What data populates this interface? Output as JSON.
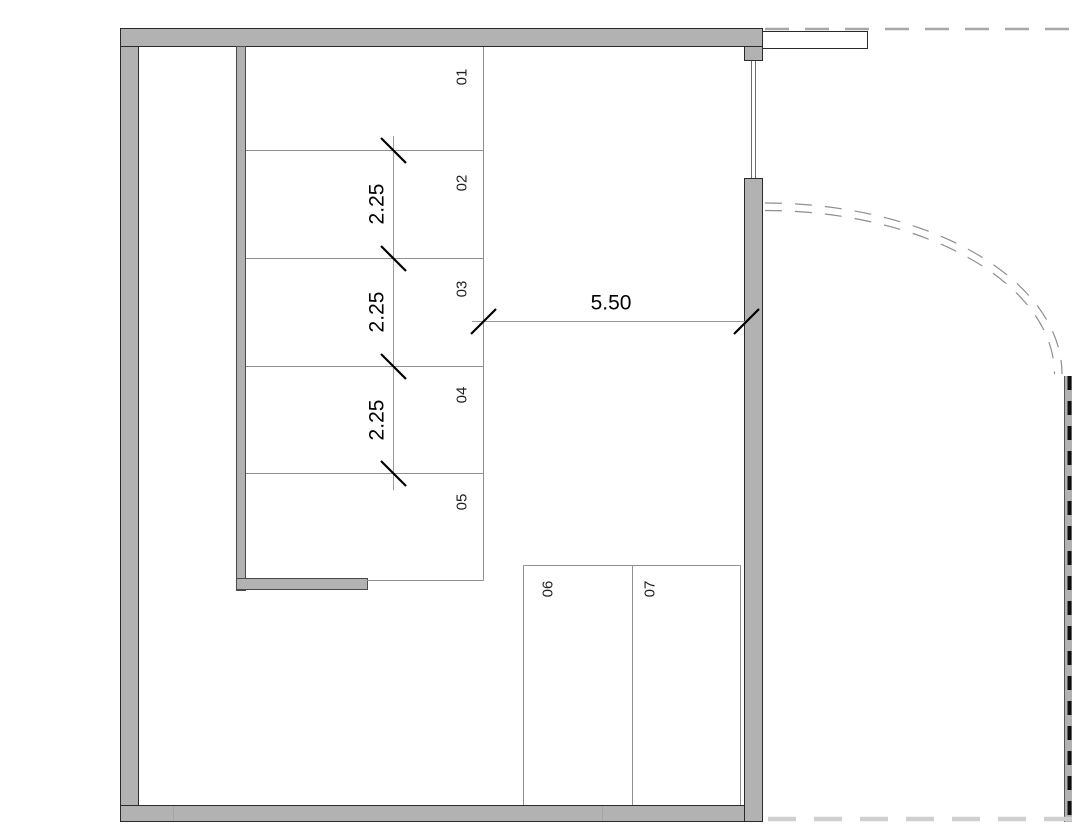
{
  "plan": {
    "stall_labels": [
      "01",
      "02",
      "03",
      "04",
      "05",
      "06",
      "07"
    ],
    "dimensions": {
      "spacing_labels": [
        "2.25",
        "2.25",
        "2.25"
      ],
      "opening_label": "5.50"
    },
    "colors": {
      "wall_fill": "#b2b2b2",
      "wall_outline": "#2a2a2a",
      "thin_line": "#8f8f8f",
      "dim_line": "#999999",
      "dim_text": "#000000",
      "label_text": "#1f1f1f",
      "dash_boundary": "#a8a8a8",
      "dash_light": "#cfcfcf",
      "fence_dash": "#111111"
    }
  }
}
